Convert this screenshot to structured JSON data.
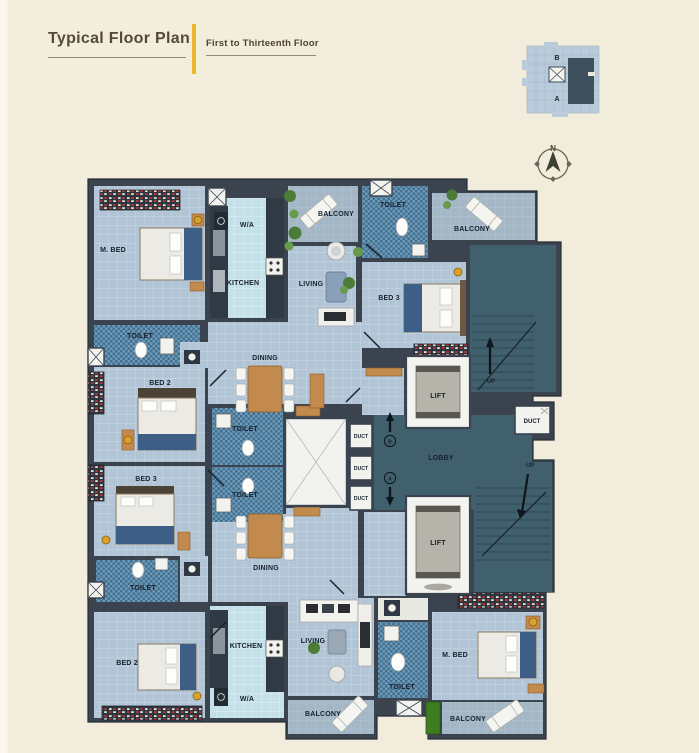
{
  "header": {
    "title": "Typical Floor Plan",
    "subtitle": "First to Thirteenth Floor",
    "accent_color": "#E9B82C"
  },
  "key_plan": {
    "wing_top": "B",
    "wing_bottom": "A"
  },
  "compass": {
    "north": "N"
  },
  "plan": {
    "labels": {
      "m_bed_top": "M. BED",
      "wa_top": "W/A",
      "kitchen_top": "KITCHEN",
      "balcony_top_left": "BALCONY",
      "toilet_top": "TOILET",
      "balcony_top_right": "BALCONY",
      "living_top": "LIVING",
      "bed3_top": "BED 3",
      "toilet_mid_left": "TOILET",
      "bed2_top": "BED 2",
      "dining_top": "DINING",
      "toilet_center_upper": "TOILET",
      "toilet_center_lower": "TOILET",
      "bed3_left": "BED 3",
      "toilet_left_lower": "TOILET",
      "dining_bottom": "DINING",
      "bed2_bottom": "BED 2",
      "kitchen_bottom": "KITCHEN",
      "wa_bottom": "W/A",
      "living_bottom": "LIVING",
      "toilet_bottom_mid": "TOILET",
      "m_bed_bottom": "M. BED",
      "balcony_bottom_mid": "BALCONY",
      "balcony_bottom_right": "BALCONY",
      "lift_upper": "LIFT",
      "lift_lower": "LIFT",
      "lobby": "LOBBY",
      "duct_1": "DUCT",
      "duct_2": "DUCT",
      "duct_3": "DUCT",
      "duct_right": "DUCT",
      "up_top_right": "UP",
      "up_bottom_right": "UP",
      "marker_b": "B",
      "marker_a": "A"
    },
    "colors": {
      "background": "#F2ECDB",
      "wall": "#3A434E",
      "floor": "#B2C5D6",
      "kitchen_floor": "#C4E1EA",
      "toilet_tile": "#6E9AB9",
      "balcony_floor": "#A3B7C6",
      "core_teal": "#41606D",
      "wood": "#C28A4C",
      "bed_blue": "#3D5F87",
      "green_mat": "#3E7C20",
      "accent_gold": "#D9A22E"
    }
  }
}
